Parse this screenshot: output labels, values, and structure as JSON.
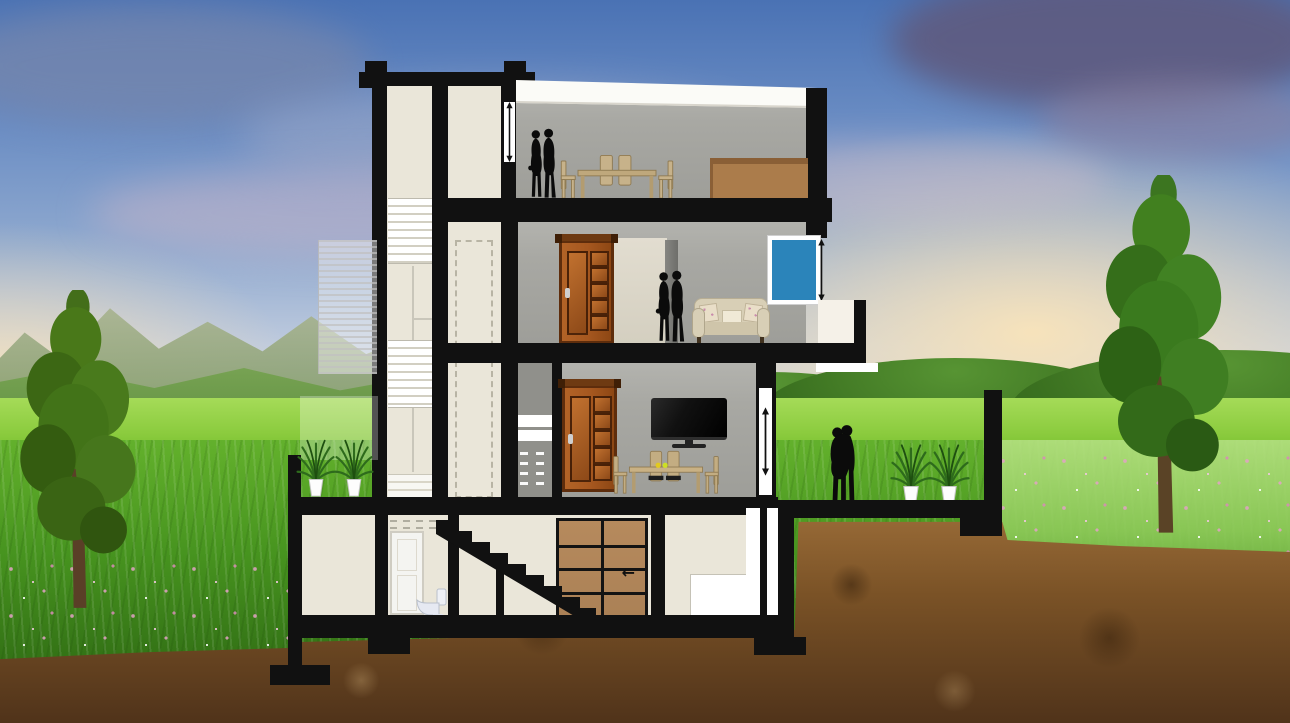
{
  "meta": {
    "title": "Three-storey house cross-section illustration",
    "type": "architectural-section",
    "environment": "sunset sky, green hills and meadow, tall grass with wild flowers, soil cross-section with foundations, one tree on each side"
  },
  "colors": {
    "ink": "#111111",
    "cream": "#eae6d9",
    "room-gray": "#a8a8a3",
    "roof-white": "#fbfbf7",
    "window-blue": "#2b84ba",
    "garage-brown": "#ab8156",
    "sideboard-tan": "#ab7c4b",
    "sofa-beige": "#d8cfb6",
    "wood-light": "#c7b28a",
    "sky-top": "#4a72b4",
    "sky-mid": "#8fa9cf",
    "sky-low": "#ddd8cd",
    "sky-warm": "#f7e3c2",
    "field-green": "#8ccc3f",
    "grass-light": "#63b12c",
    "grass-dark": "#2a6311",
    "flower-pink": "#e3a3c6",
    "soil-light": "#9a6c38",
    "soil-mid": "#7a5226",
    "soil-dark": "#50331a",
    "plant-green": "#2e6b1c",
    "trunk-brown": "#5a4326",
    "silhouette": "#0b0b0b"
  },
  "building": {
    "label": "Three-storey family house shown in section",
    "stair_tower": {
      "label": "Staircase tower with stair flights and service duct"
    },
    "floors": [
      {
        "name": "top-floor",
        "label": "Top floor",
        "items": [
          "standing couple",
          "dining table with chairs",
          "sideboard"
        ]
      },
      {
        "name": "middle-floor",
        "label": "Middle floor",
        "items": [
          "wooden door",
          "standing couple",
          "sofa with cushions",
          "blue window",
          "balcony"
        ]
      },
      {
        "name": "lower-floor",
        "label": "Lower floor",
        "items": [
          "wooden door",
          "wall TV",
          "dining table with chairs",
          "open terrace with couple and palm plants"
        ]
      },
      {
        "name": "ground-floor",
        "label": "Ground / garage level",
        "items": [
          "store room",
          "bathroom with toilet",
          "staircase",
          "garage door",
          "entry steps"
        ]
      }
    ],
    "garage": {
      "arrow_glyph": "←"
    },
    "dimension_markers": [
      "tower-wall",
      "window-right",
      "living-room-wall"
    ]
  }
}
